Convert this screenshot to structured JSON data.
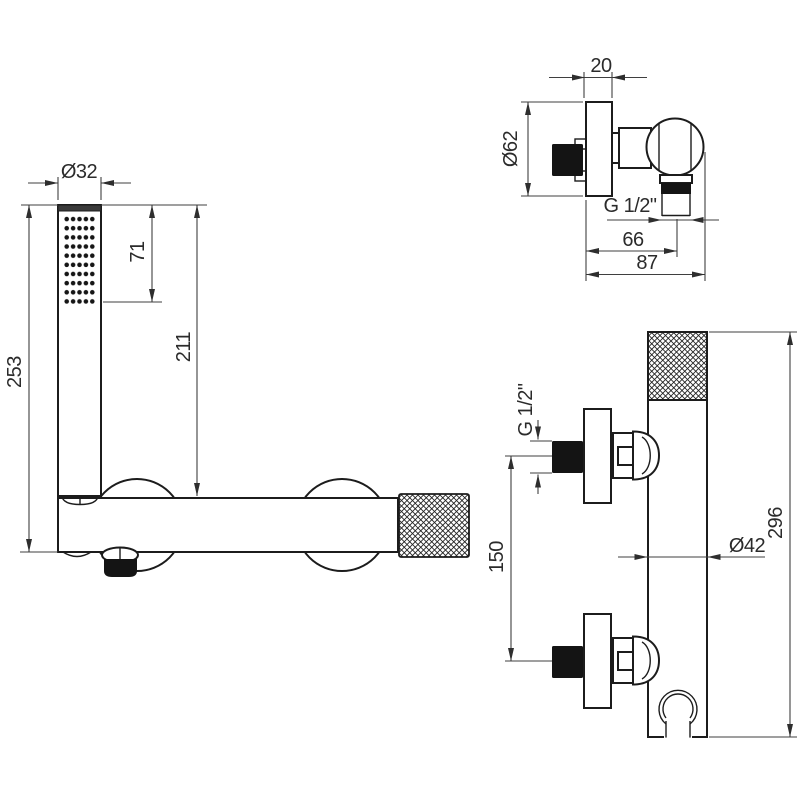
{
  "drawing": {
    "colors": {
      "background": "#ffffff",
      "line": "#1c1c1c",
      "dimension_line": "#3f3f3f",
      "text": "#2b2b2b",
      "solid_fill": "#141414"
    },
    "views": {
      "hand_shower_side": {
        "dims": {
          "head_diameter": "Ø32",
          "spray_face_length": "71",
          "shower_length": "211",
          "overall_height": "253"
        }
      },
      "valve_side": {
        "dims": {
          "rosette_depth": "20",
          "rosette_diameter": "Ø62",
          "outlet_thread": "G 1/2\"",
          "outlet_offset": "66",
          "overall_depth": "87"
        }
      },
      "bar_front": {
        "dims": {
          "inlet_thread": "G 1/2\"",
          "connection_spacing": "150",
          "bar_diameter": "Ø42",
          "bar_length": "296"
        }
      }
    }
  }
}
